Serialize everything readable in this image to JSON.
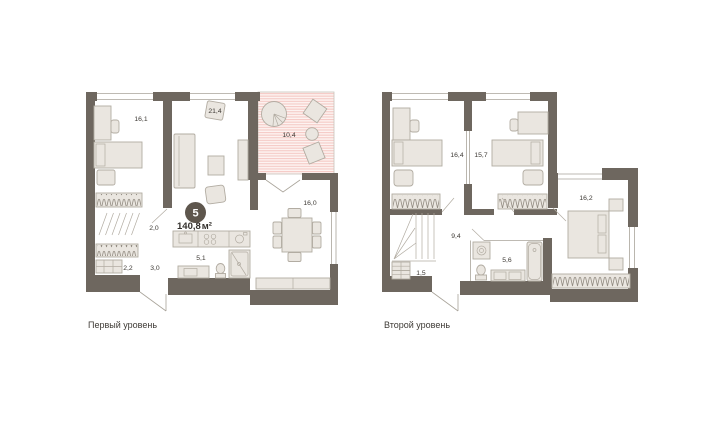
{
  "unit": {
    "badge_number": "5",
    "total_area": "140,8",
    "area_unit": "м²"
  },
  "levels": [
    {
      "caption": "Первый уровень",
      "rooms": [
        {
          "name": "bedroom",
          "area": "16,1"
        },
        {
          "name": "living-room",
          "area": "21,4"
        },
        {
          "name": "terrace",
          "area": "10,4"
        },
        {
          "name": "dining-room",
          "area": "16,0"
        },
        {
          "name": "hall",
          "area": "2,0"
        },
        {
          "name": "corridor",
          "area": "3,0"
        },
        {
          "name": "storage",
          "area": "2,2"
        },
        {
          "name": "kitchen",
          "area": "5,1"
        }
      ]
    },
    {
      "caption": "Второй уровень",
      "rooms": [
        {
          "name": "bedroom-1",
          "area": "16,4"
        },
        {
          "name": "bedroom-2",
          "area": "15,7"
        },
        {
          "name": "bedroom-3",
          "area": "16,2"
        },
        {
          "name": "hall",
          "area": "9,4"
        },
        {
          "name": "storage",
          "area": "1,5"
        },
        {
          "name": "bathroom",
          "area": "5,6"
        }
      ]
    }
  ],
  "colors": {
    "wall": "#6e675f",
    "furniture_fill": "#eae6e0",
    "furniture_stroke": "#b2aca2",
    "thin_line": "#a9a49a",
    "terrace_stripe": "#f5cac5",
    "terrace_bg": "#fdf3f1",
    "label_text": "#3e3a35",
    "badge_bg": "#5e564d",
    "badge_text": "#ffffff"
  }
}
